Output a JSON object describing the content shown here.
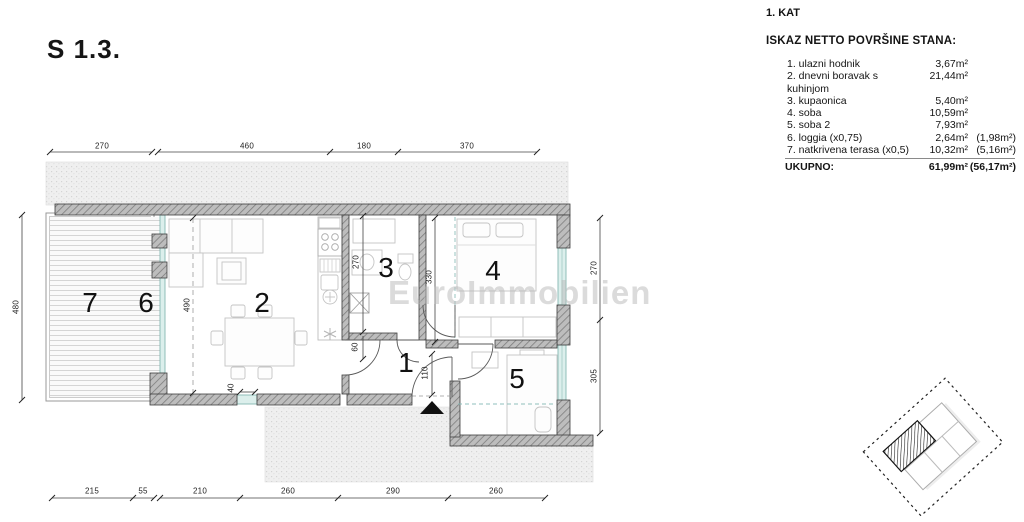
{
  "title": "S 1.3.",
  "watermark": "EuroImmobilien",
  "legend": {
    "floor": "1. KAT",
    "heading": "ISKAZ NETTO POVRŠINE STANA:",
    "items": [
      {
        "label": "1. ulazni hodnik",
        "value": "3,67m²",
        "extra": ""
      },
      {
        "label": "2. dnevni boravak s kuhinjom",
        "value": "21,44m²",
        "extra": ""
      },
      {
        "label": "3. kupaonica",
        "value": "5,40m²",
        "extra": ""
      },
      {
        "label": "4. soba",
        "value": "10,59m²",
        "extra": ""
      },
      {
        "label": "5. soba 2",
        "value": "7,93m²",
        "extra": ""
      },
      {
        "label": "6. loggia (x0,75)",
        "value": "2,64m²",
        "extra": "(1,98m²)"
      },
      {
        "label": "7. natkrivena terasa (x0,5)",
        "value": "10,32m²",
        "extra": "(5,16m²)"
      }
    ],
    "total_label": "UKUPNO:",
    "total_value": "61,99m²",
    "total_extra": "(56,17m²)"
  },
  "plan": {
    "rooms": [
      "1",
      "2",
      "3",
      "4",
      "5",
      "6",
      "7"
    ],
    "dims": {
      "top": [
        "270",
        "460",
        "180",
        "370"
      ],
      "bottom": [
        "215",
        "55",
        "210",
        "260",
        "290",
        "260"
      ],
      "left": [
        "480"
      ],
      "right": [
        "270",
        "305"
      ],
      "interior": [
        "490",
        "270",
        "330",
        "60",
        "110",
        "40"
      ]
    },
    "colors": {
      "wall": "#bdbdbd",
      "glazing": "#dcefec",
      "glazing_stroke": "#85b8b2",
      "entry_marker": "#111111"
    }
  }
}
